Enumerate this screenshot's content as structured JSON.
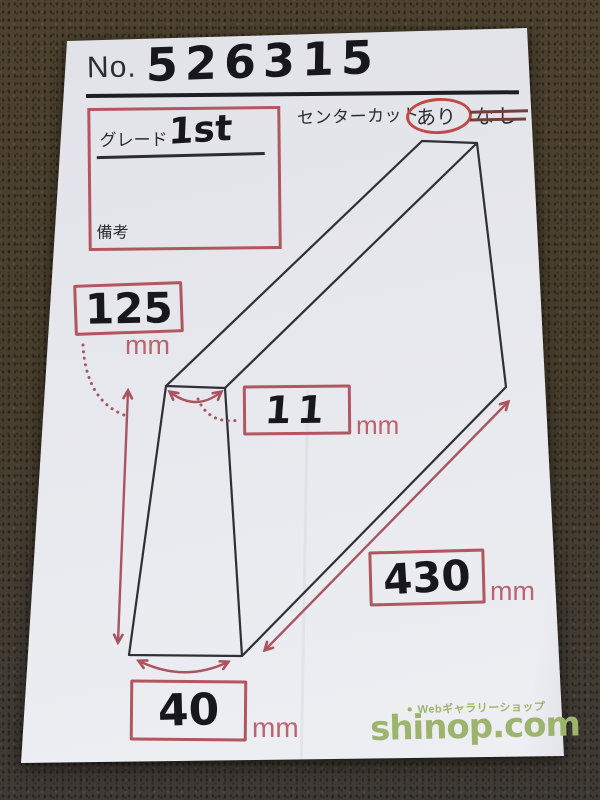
{
  "header": {
    "no_label": "No.",
    "no_value": "526315"
  },
  "grade_box": {
    "grade_label": "グレード",
    "grade_value": "1st",
    "remarks_label": "備考",
    "remarks_value": ""
  },
  "center_cut": {
    "label": "センターカット",
    "option_yes": "あり",
    "option_no": "なし",
    "selected": "あり"
  },
  "dimensions": {
    "height": {
      "value": "125",
      "unit": "mm"
    },
    "top_thickness": {
      "value": "11",
      "unit": "mm"
    },
    "length": {
      "value": "430",
      "unit": "mm"
    },
    "bottom_width": {
      "value": "40",
      "unit": "mm"
    }
  },
  "logo": {
    "bullet": "●",
    "tagline": "Webギャラリーショップ",
    "site_name": "shinop.com"
  },
  "colors": {
    "annotation_red": "#b2565f",
    "circle_red": "#c04a46",
    "strike_red": "#71403a",
    "drawing_ink": "#2f2f38",
    "marker_black": "#17171d",
    "logo_green": "#9db46e",
    "paper_white": "#e9eaef",
    "carpet_brown": "#473d2c"
  }
}
